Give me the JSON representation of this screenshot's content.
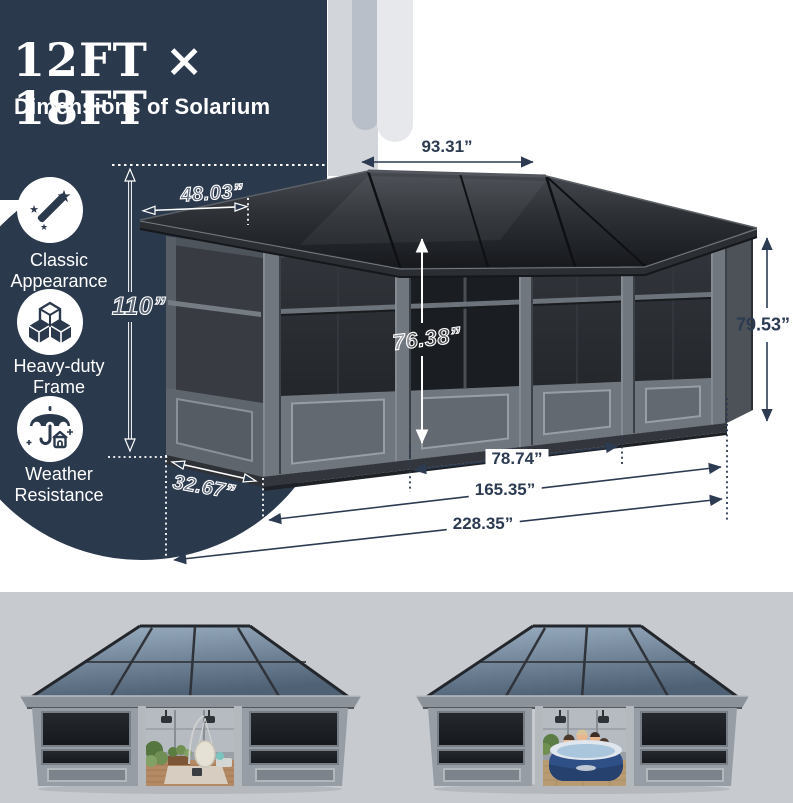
{
  "header": {
    "title": "12FT × 18FT",
    "subtitle": "Dimensions of Solarium"
  },
  "features": [
    {
      "icon": "magic-wand-icon",
      "line1": "Classic",
      "line2": "Appearance"
    },
    {
      "icon": "cubes-icon",
      "line1": "Heavy-duty",
      "line2": "Frame"
    },
    {
      "icon": "umbrella-house-icon",
      "line1": "Weather",
      "line2": "Resistance"
    }
  ],
  "dimensions": {
    "ridge_length": "93.31”",
    "roof_side": "48.03”",
    "total_height": "110”",
    "door_height": "76.38”",
    "wall_height": "79.53”",
    "door_span": "78.74”",
    "front_length": "165.35”",
    "total_length": "228.35”",
    "corner_depth": "32.67”"
  },
  "photos": [
    {
      "alt": "solarium interior with patio furniture"
    },
    {
      "alt": "solarium with inflatable hot tub"
    }
  ],
  "colors": {
    "navy": "#2b394d",
    "dim_navy": "#2c3b52",
    "white": "#ffffff",
    "strip_gray": "#c7cbd0",
    "roof_dark": "#1a1c20",
    "frame_gray": "#6e747c",
    "glass_blue": "#7f98ad",
    "hot_tub_blue": "#31508a"
  }
}
